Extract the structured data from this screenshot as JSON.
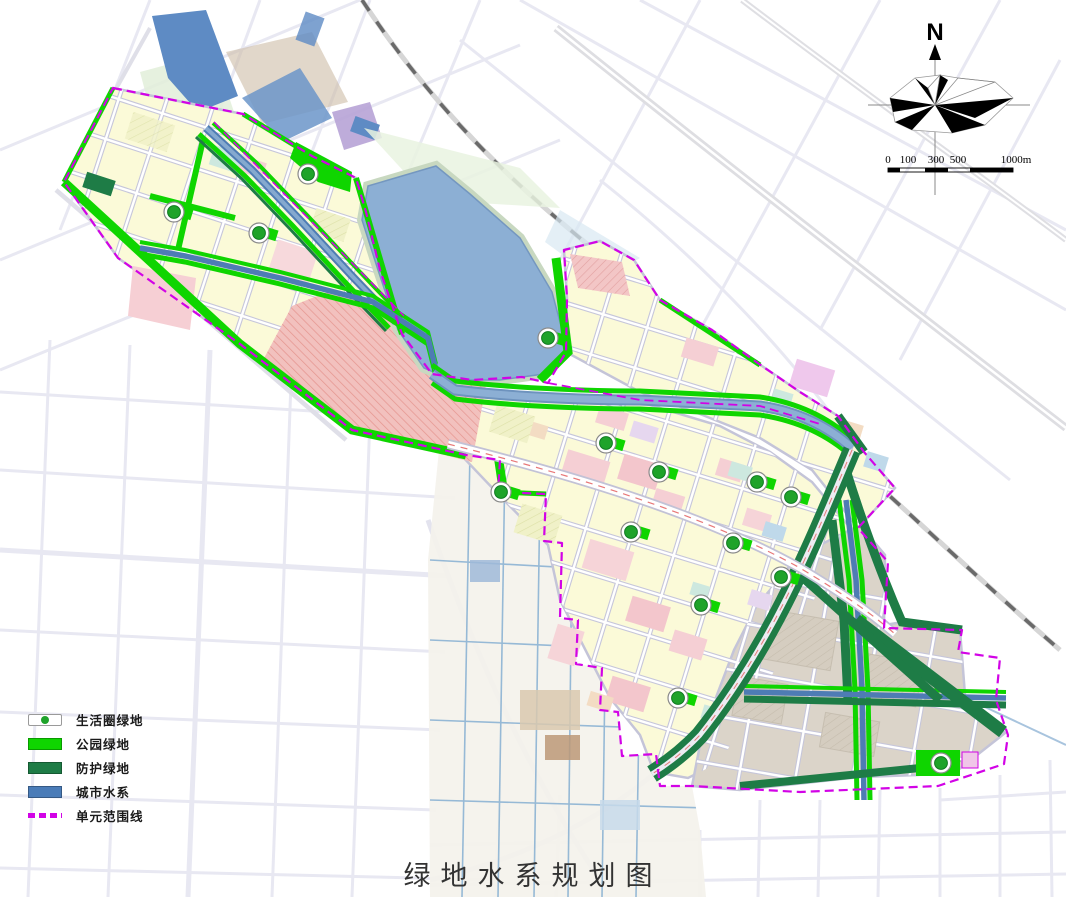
{
  "title": {
    "text": "绿地水系规划图"
  },
  "legend": {
    "items": [
      {
        "label": "生活圈绿地",
        "type": "marker",
        "color": "#1FA32A"
      },
      {
        "label": "公园绿地",
        "type": "fill",
        "color": "#0FD500"
      },
      {
        "label": "防护绿地",
        "type": "fill",
        "color": "#1E7C46"
      },
      {
        "label": "城市水系",
        "type": "fill",
        "color": "#4A7CB8"
      },
      {
        "label": "单元范围线",
        "type": "dash",
        "color": "#D203E6"
      }
    ]
  },
  "compass": {
    "north_label": "N"
  },
  "scale_bar": {
    "labels": [
      "0",
      "100",
      "300",
      "500",
      "1000m"
    ]
  },
  "map": {
    "colors": {
      "park_green": "#0FD500",
      "protective_green": "#1E7C46",
      "water_blue": "#4A7CB8",
      "lake_fill": "#8CAFD4",
      "boundary_magenta": "#D203E6",
      "residential_yellow": "#FBFAD8",
      "pink_block": "#F5CDD2",
      "salmon_hatch": "#F0BFBF",
      "reserve_tan": "#DBD4C9",
      "marker_green": "#1FA32A"
    },
    "life_circle_markers": [
      {
        "x": 308,
        "y": 174
      },
      {
        "x": 174,
        "y": 212
      },
      {
        "x": 259,
        "y": 233
      },
      {
        "x": 548,
        "y": 338
      },
      {
        "x": 501,
        "y": 492
      },
      {
        "x": 606,
        "y": 443
      },
      {
        "x": 659,
        "y": 472
      },
      {
        "x": 757,
        "y": 482
      },
      {
        "x": 791,
        "y": 497
      },
      {
        "x": 631,
        "y": 532
      },
      {
        "x": 733,
        "y": 543
      },
      {
        "x": 781,
        "y": 577
      },
      {
        "x": 701,
        "y": 605
      },
      {
        "x": 678,
        "y": 698
      },
      {
        "x": 941,
        "y": 763
      }
    ]
  }
}
